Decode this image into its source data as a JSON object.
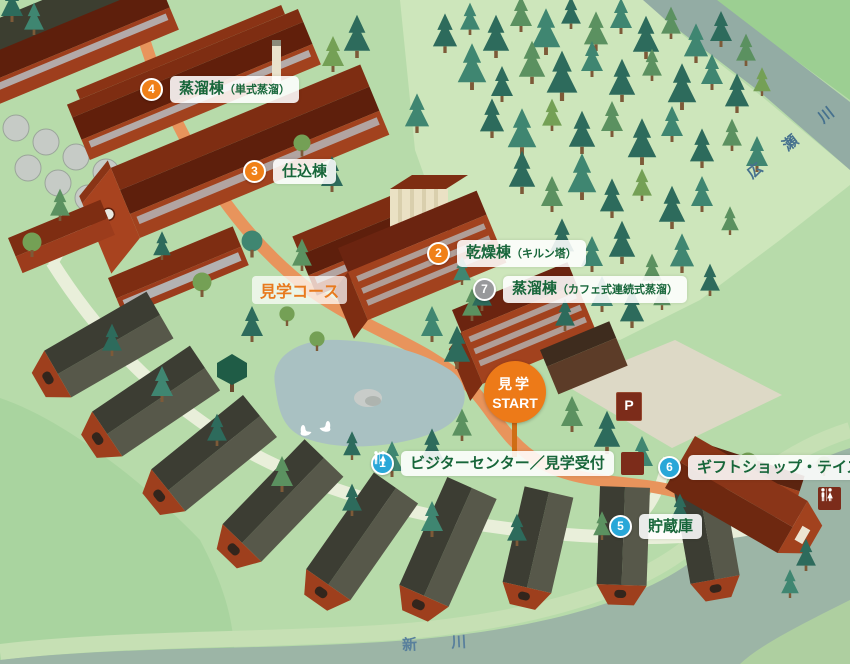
{
  "map": {
    "course_label": "見学コース",
    "start": {
      "line1": "見学",
      "line2": "START"
    },
    "parking": "P",
    "rivers": {
      "hirose": "広 瀬 川",
      "nikkawa": "新 川"
    },
    "markers": [
      {
        "num": "1",
        "label": "ビジターセンター／見学受付",
        "sub": "",
        "color": "#29a7d8"
      },
      {
        "num": "2",
        "label": "乾燥棟",
        "sub": "（キルン塔）",
        "color": "#f08018"
      },
      {
        "num": "3",
        "label": "仕込棟",
        "sub": "",
        "color": "#f08018"
      },
      {
        "num": "4",
        "label": "蒸溜棟",
        "sub": "（単式蒸溜）",
        "color": "#f08018"
      },
      {
        "num": "5",
        "label": "貯蔵庫",
        "sub": "",
        "color": "#29a7d8"
      },
      {
        "num": "6",
        "label": "ギフトショップ・テイスティングバー",
        "sub": "",
        "color": "#29a7d8"
      },
      {
        "num": "7",
        "label": "蒸溜棟",
        "sub": "（カフェ式連続式蒸溜）",
        "color": "#98999b"
      }
    ],
    "colors": {
      "marker_orange": "#f08018",
      "marker_blue": "#29a7d8",
      "marker_gray": "#98999b",
      "label_text_green": "#17663a",
      "course_text_orange": "#e87a1e",
      "start_circle": "#ed7a18",
      "facility_icon_bg": "#7c2c1a",
      "base_green": "#b7dbaa",
      "river_gray": "#9cb5a6"
    }
  }
}
